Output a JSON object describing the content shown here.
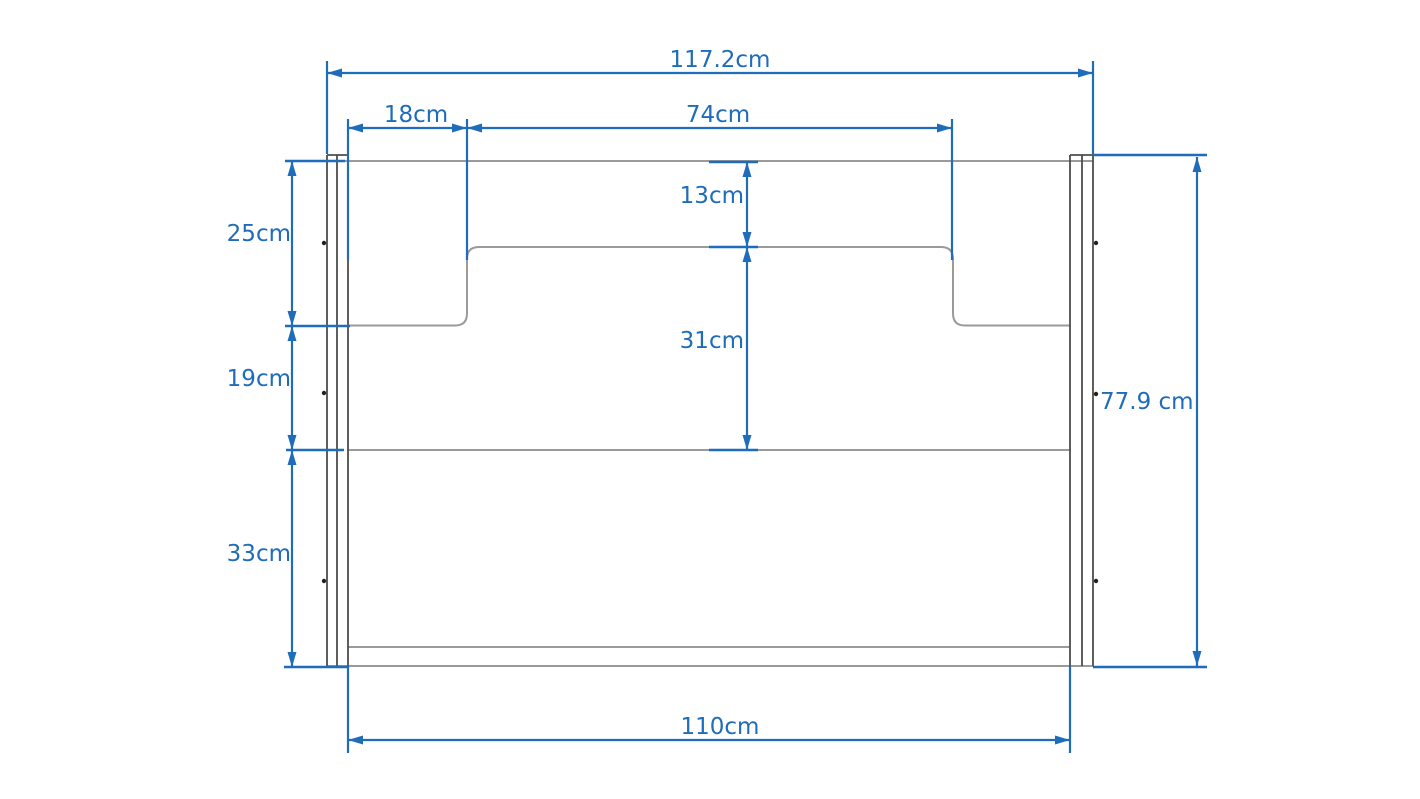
{
  "drawing": {
    "type": "furniture-front-view-dimension-diagram",
    "unit": "cm",
    "dimensions": {
      "overall_width": "117.2cm",
      "side_inset_width": "18cm",
      "center_section_width": "74cm",
      "top_drop_height": "13cm",
      "recess_height": "31cm",
      "upper_left_height": "25cm",
      "middle_left_height": "19cm",
      "lower_left_height": "33cm",
      "overall_height": "77.9 cm",
      "inner_width": "110cm"
    },
    "colors": {
      "dimension_blue": "#1f6cba",
      "object_gray": "#9a9a9a",
      "panel_gray": "#4d4d4d"
    }
  }
}
